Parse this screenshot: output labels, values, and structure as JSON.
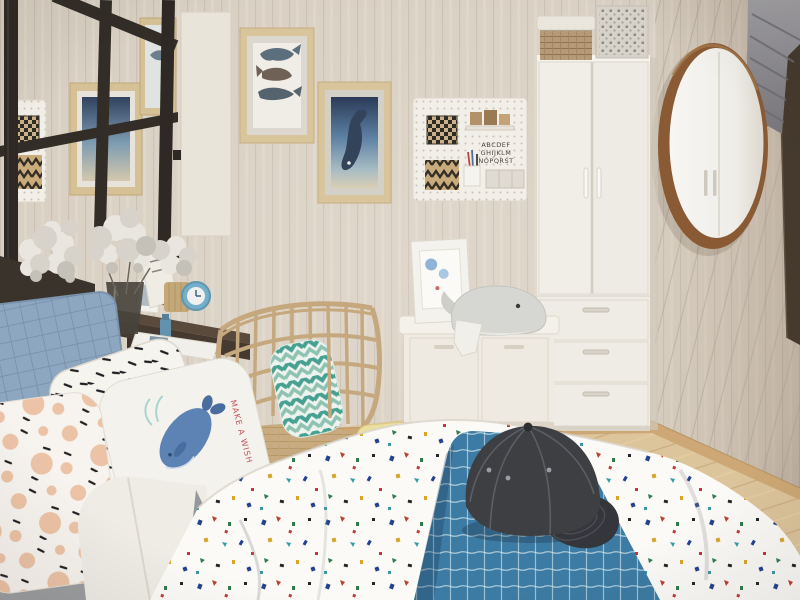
{
  "meta": {
    "kind": "interior photograph",
    "description": "Scandinavian style kids bedroom: wood-panel walls, black canopy bed with whale-print pillows and terrazzo-speck duvet, blue check runner with a charcoal baseball cap, rattan basket chair with teal chevron cushion, dark floating desk with white flowers, white storage bench with whale plush, tall white wardrobe with storage boxes, white pegboard organizers, round walnut mirror and a gray roman shade"
  },
  "palette": {
    "wall": "#d8cfc2",
    "wall_plank_line": "#bdb2a2",
    "floor": "#dcc49b",
    "baseboard": "#cda876",
    "canopy_frame": "#2e2924",
    "wardrobe": "#efece5",
    "bench": "#f4f1ea",
    "mirror_frame": "#8a5a35",
    "curtain": "#8f8e92",
    "window_dark": "#453a2d",
    "desk": "#463a30",
    "runner_blue": "#3c7ba3",
    "cap_charcoal": "#3d3f43",
    "quilt_pillow": "#8ea7c0",
    "whale_art_blue": "#5d82b4",
    "pillow_text_red": "#c4525c",
    "rattan": "#c6a87e",
    "chevron_teal": "#47a191",
    "terrazzo_specks": [
      "#24418c",
      "#c03a31",
      "#d7a728",
      "#2f7d4c",
      "#3a9aa3",
      "#23262b"
    ]
  },
  "wall_art": {
    "frame_blue_small": "small ocean print in wood frame",
    "frame_whale_small": "small whale print in wood frame",
    "frame_whale_trio": "three stacked whales print in wood frame",
    "frame_ocean_whale": "diving whale ocean print in wood frame"
  },
  "pegboard_left": {
    "label": "white pegboard with checkered box and zigzag box"
  },
  "pegboard_right": {
    "label": "white pegboard organizer",
    "poster_lines": [
      "ABCDEF",
      "GHIJKLM",
      "NOPQRST"
    ],
    "items": [
      "checkered box",
      "wood blocks shelf",
      "alphabet poster",
      "zigzag box",
      "pen cup with pens",
      "small organizer trays"
    ]
  },
  "wardrobe": {
    "doors": 2,
    "drawers": 3,
    "boxes_on_top": [
      "wicker basket with white lid",
      "patterned storage box"
    ]
  },
  "mirror": {
    "shape": "round",
    "frame": "walnut wood",
    "reflection": "white wardrobe doors"
  },
  "curtain": {
    "style": "gray pleated roman shade"
  },
  "window": {
    "state": "dark opening at right edge"
  },
  "desk": {
    "material": "dark walnut floating desk",
    "items": [
      "white flower bouquets",
      "dark glass vase",
      "white paper bag",
      "small photo frame",
      "knitted basket",
      "blue round clock",
      "blue bottle",
      "white tray"
    ]
  },
  "chair": {
    "type": "rattan wire basket chair",
    "cushion": "teal chevron pillow",
    "base": "woven seat pad"
  },
  "bench": {
    "type": "white storage bench",
    "drawers": 2,
    "items_on_top": [
      "white photo frame",
      "gray whale plush with white bib"
    ]
  },
  "bed": {
    "frame": "black metal canopy frame",
    "headboard": "dark wood headboard shelf",
    "pillows": [
      "blue quilted pillow",
      "white pillow with black dashes",
      "white whale-print pillow",
      "white pillow with peach dots and dashes",
      "plain white pillow",
      "pale yellow pillow",
      "two white roll pillows"
    ],
    "whale_pillow": {
      "text": "MAKE A WISH",
      "text_color": "#c4525c"
    },
    "duvet": "white duvet with multicolor terrazzo specks",
    "runner": "steel blue windowpane-check runner",
    "cap": "charcoal flat-brim baseball cap with eyelets"
  }
}
